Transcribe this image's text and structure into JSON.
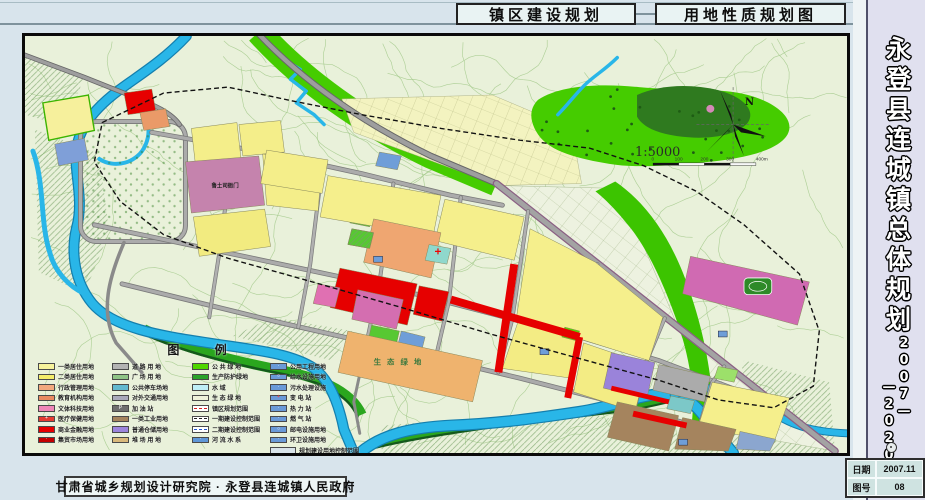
{
  "header": {
    "title_left": "镇区建设规划",
    "title_right": "用地性质规划图"
  },
  "sidebar": {
    "title": "永登县连城镇总体规划",
    "period_a": "2007—",
    "period_b": "—2020"
  },
  "footer": {
    "credit": "甘肃省城乡规划设计研究院 · 永登县连城镇人民政府"
  },
  "info_table": {
    "rows": [
      {
        "label": "日期",
        "value": "2007.11"
      },
      {
        "label": "图号",
        "value": "08"
      }
    ]
  },
  "map": {
    "compass_label": "N",
    "scale_text": "1:5000",
    "scale_ticks": [
      "0",
      "100",
      "200",
      "300",
      "400m"
    ],
    "labels": {
      "heritage_site": "鲁土司衙门",
      "eco_green": "生 态 绿 地"
    },
    "colors": {
      "water": "#29b6e8",
      "green": "#45cc00",
      "road": "#a0a0a0",
      "commercial_red": "#e60000",
      "residential_yellow": "#f5ef8c"
    }
  },
  "legend": {
    "title": "图  例",
    "columns": [
      [
        {
          "label": "一类居住用地",
          "color": "#f7f39c"
        },
        {
          "label": "二类居住用地",
          "color": "#f3ed6a"
        },
        {
          "label": "行政管理用地",
          "color": "#f2a97e"
        },
        {
          "label": "教育机构用地",
          "color": "#e98a62"
        },
        {
          "label": "文体科技用地",
          "color": "#ef86b7"
        },
        {
          "label": "医疗保健用地",
          "color": "#e43b32",
          "symbol": "+",
          "symbol_color": "#ffffff"
        },
        {
          "label": "商业金融用地",
          "color": "#e60000"
        },
        {
          "label": "集贸市场用地",
          "color": "#c40000",
          "symbol": "·",
          "symbol_color": "#ffffff"
        }
      ],
      [
        {
          "label": "道 路 用 地",
          "color": "#b3b3b3"
        },
        {
          "label": "广 场 用 地",
          "color": "#8fc487"
        },
        {
          "label": "公共停车场地",
          "color": "#62b8cf"
        },
        {
          "label": "对外交通用地",
          "color": "#a9a9bb"
        },
        {
          "label": "加  油  站",
          "color": "#6f6f6f",
          "symbol": "P",
          "symbol_color": "#ffffff"
        },
        {
          "label": "一类工业用地",
          "color": "#a5845e"
        },
        {
          "label": "普通仓储用地",
          "color": "#9c85dc"
        },
        {
          "label": "堆 场 用 地",
          "color": "#d9b97c"
        }
      ],
      [
        {
          "label": "公 共 绿 地",
          "color": "#4ed600"
        },
        {
          "label": "生产防护绿地",
          "color": "#2ba32b"
        },
        {
          "label": "水      域",
          "color": "#bfeef7"
        },
        {
          "label": "生 态 绿 地",
          "color": "#eef2da"
        },
        {
          "label": "镇区规划范围",
          "type": "line",
          "line": "#d42020"
        },
        {
          "label": "一期建设控制范围",
          "type": "line",
          "line": "#222222"
        },
        {
          "label": "二期建设控制范围",
          "type": "line",
          "line": "#2255cc"
        },
        {
          "label": "河 流 水 系",
          "color": "#5f97d8",
          "symbol": "·",
          "symbol_color": "#ffffff"
        }
      ],
      [
        {
          "label": "公用工程用地",
          "color": "#6a9ad8",
          "symbol": "·",
          "symbol_color": "#ffffff"
        },
        {
          "label": "给水设施用地",
          "color": "#6a9ad8",
          "symbol": "○",
          "symbol_color": "#ffffff"
        },
        {
          "label": "污水处理设施",
          "color": "#6a9ad8",
          "symbol": "·",
          "symbol_color": "#ffffff"
        },
        {
          "label": "变  电  站",
          "color": "#6a9ad8",
          "symbol": "+",
          "symbol_color": "#ff4040"
        },
        {
          "label": "热  力  站",
          "color": "#6a9ad8",
          "symbol": "·",
          "symbol_color": "#ffffff"
        },
        {
          "label": "燃  气  站",
          "color": "#6a9ad8",
          "symbol": "·",
          "symbol_color": "#ffffff"
        },
        {
          "label": "邮电设施用地",
          "color": "#6a9ad8",
          "symbol": "○",
          "symbol_color": "#ffffff"
        },
        {
          "label": "环卫设施用地",
          "color": "#6a9ad8",
          "symbol": "·",
          "symbol_color": "#ffffff"
        },
        {
          "label": "规划建设用地控制范围",
          "color": "#d9e4ea",
          "wide": true
        }
      ]
    ]
  }
}
